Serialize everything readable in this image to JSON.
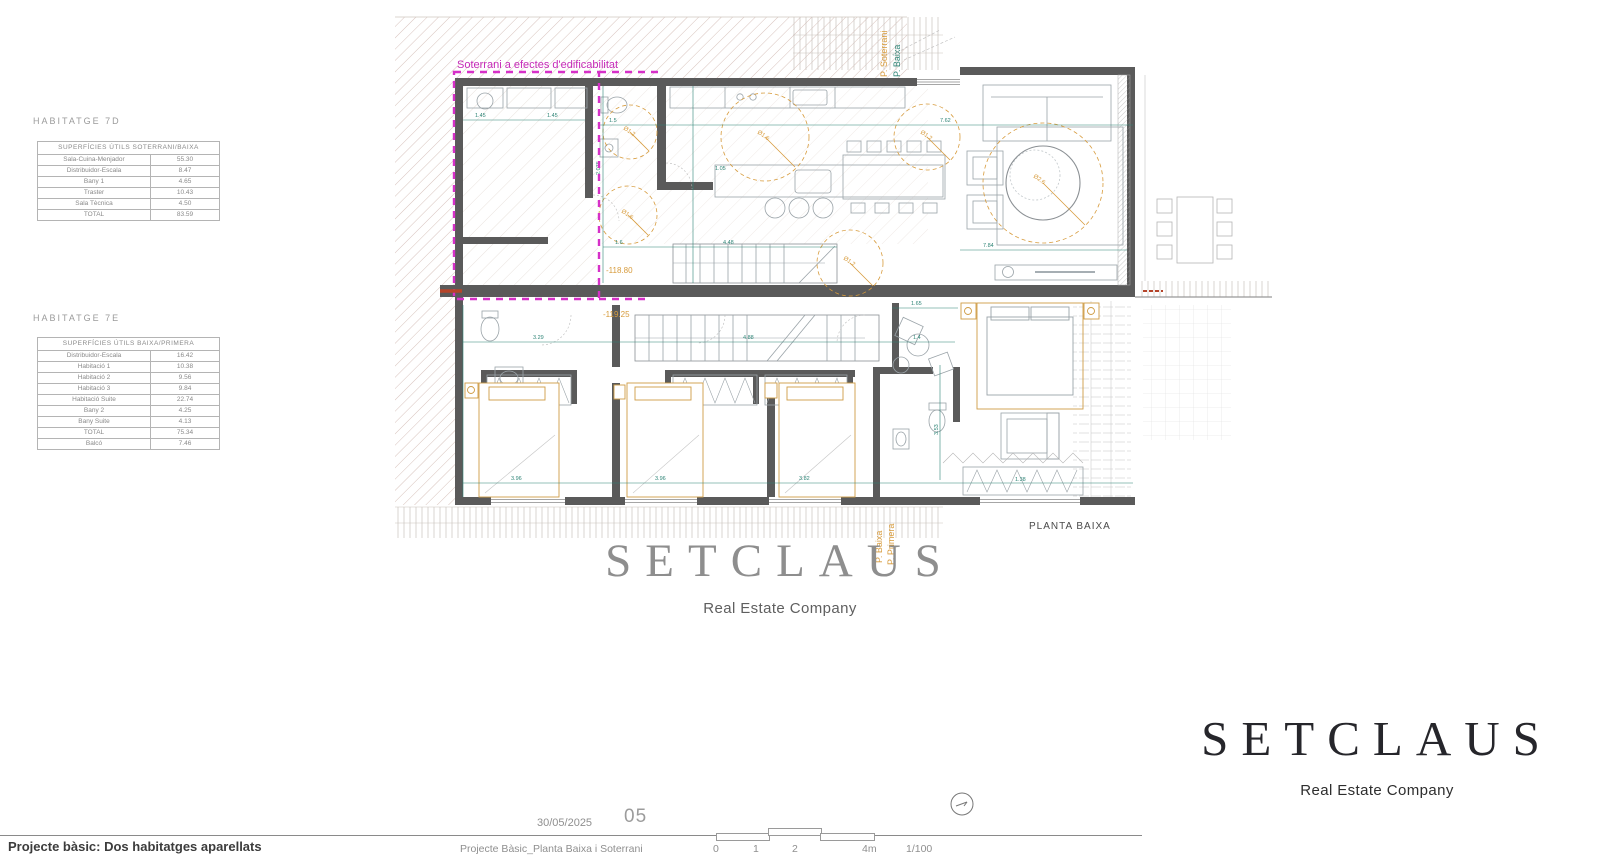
{
  "tables": {
    "t7d": {
      "title": "HABITATGE 7D",
      "header": "SUPERFÍCIES ÚTILS SOTERRANI/BAIXA",
      "rows": [
        {
          "label": "Sala-Cuina-Menjador",
          "value": "55.30"
        },
        {
          "label": "Distribuidor-Escala",
          "value": "8.47"
        },
        {
          "label": "Bany 1",
          "value": "4.65"
        },
        {
          "label": "Traster",
          "value": "10.43"
        },
        {
          "label": "Sala Tècnica",
          "value": "4.50"
        },
        {
          "label": "TOTAL",
          "value": "83.59"
        }
      ]
    },
    "t7e": {
      "title": "HABITATGE 7E",
      "header": "SUPERFÍCIES ÚTILS BAIXA/PRIMERA",
      "rows": [
        {
          "label": "Distribuidor-Escala",
          "value": "16.42"
        },
        {
          "label": "Habitació 1",
          "value": "10.38"
        },
        {
          "label": "Habitació 2",
          "value": "9.56"
        },
        {
          "label": "Habitació 3",
          "value": "9.84"
        },
        {
          "label": "Habitació Suite",
          "value": "22.74"
        },
        {
          "label": "Bany 2",
          "value": "4.25"
        },
        {
          "label": "Bany Suite",
          "value": "4.13"
        },
        {
          "label": "TOTAL",
          "value": "75.34"
        },
        {
          "label": "Balcó",
          "value": "7.46"
        }
      ]
    }
  },
  "plan": {
    "edificability_note": "Soterrani a efectes d'edificabilitat",
    "level_upper": "-118.80",
    "level_lower": "-119.25",
    "floor_label": "PLANTA BAIXA",
    "axis_top": [
      "P. Soterrani",
      "P. Baixa"
    ],
    "axis_bottom": [
      "P. Baixa",
      "P. Primera"
    ],
    "lights": [
      "Ø1.2",
      "Ø1.6",
      "Ø1.6",
      "Ø1.2",
      "Ø1.2",
      "Ø2.6"
    ],
    "dims": [
      "1.45",
      "1.45",
      "1.5",
      "2.075",
      "7.62",
      "1.6",
      "4.48",
      "7.84",
      "1.05",
      "3.29",
      "4.88",
      "3.96",
      "3.96",
      "3.82",
      "1.65",
      "3.53",
      "1.38",
      "1.4"
    ]
  },
  "watermark": {
    "brand": "SETCLAUS",
    "tagline": "Real Estate Company"
  },
  "logo": {
    "brand": "SETCLAUS",
    "tagline": "Real Estate Company"
  },
  "footer": {
    "project_title": "Projecte bàsic: Dos habitatges aparellats",
    "date": "30/05/2025",
    "sheet_number": "05",
    "drawing_title": "Projecte Bàsic_Planta Baixa i Soterrani",
    "scale_ticks": [
      "0",
      "1",
      "2",
      "4m"
    ],
    "scale_ratio": "1/100"
  },
  "colors": {
    "wall": "#5A5A5A",
    "dimension_teal": "#2E8476",
    "accent_orange": "#D79B3C",
    "magenta": "#D630C8",
    "brand_dark": "#26262B",
    "brand_gray": "#8E8E8E"
  }
}
